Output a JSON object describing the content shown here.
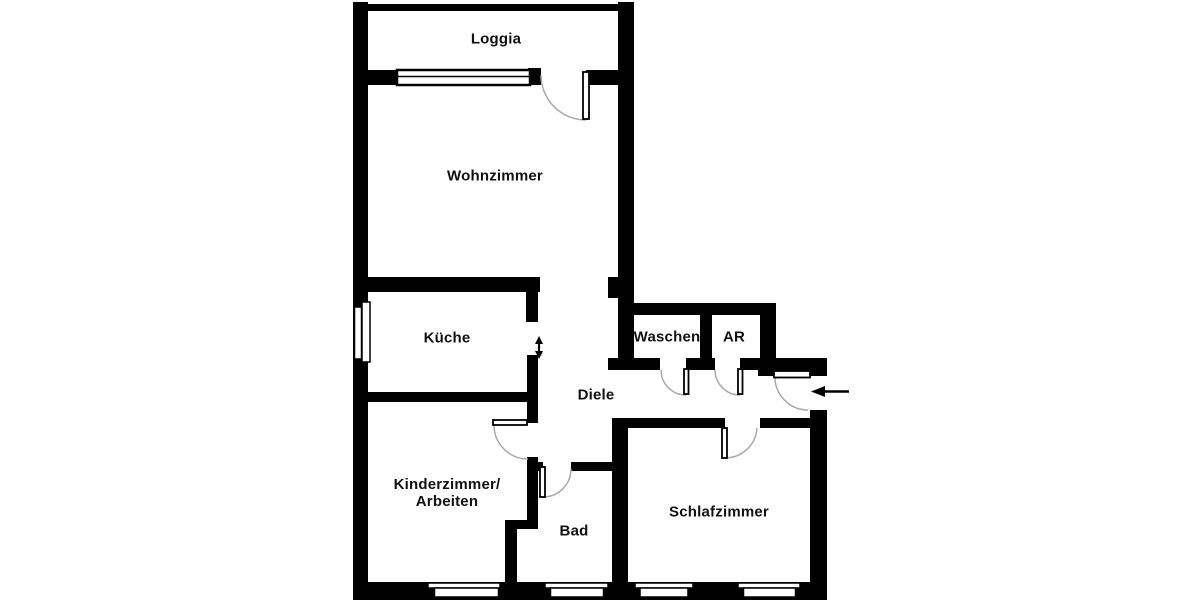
{
  "plan": {
    "type": "apartment-floor-plan",
    "language": "de",
    "colors": {
      "wall": "#000000",
      "background": "#ffffff",
      "door_arc": "#aaaaaa",
      "symbol": "#000000"
    },
    "rooms": [
      {
        "id": "loggia",
        "label": "Loggia"
      },
      {
        "id": "wohnzimmer",
        "label": "Wohnzimmer"
      },
      {
        "id": "kueche",
        "label": "Küche"
      },
      {
        "id": "waschen",
        "label": "Waschen"
      },
      {
        "id": "ar",
        "label": "AR"
      },
      {
        "id": "diele",
        "label": "Diele"
      },
      {
        "id": "kinderzimmer",
        "label_line1": "Kinderzimmer/",
        "label_line2": "Arbeiten"
      },
      {
        "id": "bad",
        "label": "Bad"
      },
      {
        "id": "schlafzimmer",
        "label": "Schlafzimmer"
      }
    ],
    "symbols": {
      "entrance_arrow": "arrow-left-into-entrance-door",
      "sliding_door_arrow": "vertical-double-arrow-kitchen-opening",
      "windows": [
        "loggia-to-wohnzimmer-window",
        "kueche-left-wall-window",
        "kinderzimmer-bottom-window",
        "bad-bottom-window",
        "schlafzimmer-bottom-window-left",
        "schlafzimmer-bottom-window-right"
      ],
      "doors": [
        "balcony-door-wohnzimmer-loggia",
        "entrance-door-right-wall",
        "waschen-door",
        "ar-door",
        "kinderzimmer-door",
        "bad-door",
        "schlafzimmer-door"
      ]
    }
  }
}
